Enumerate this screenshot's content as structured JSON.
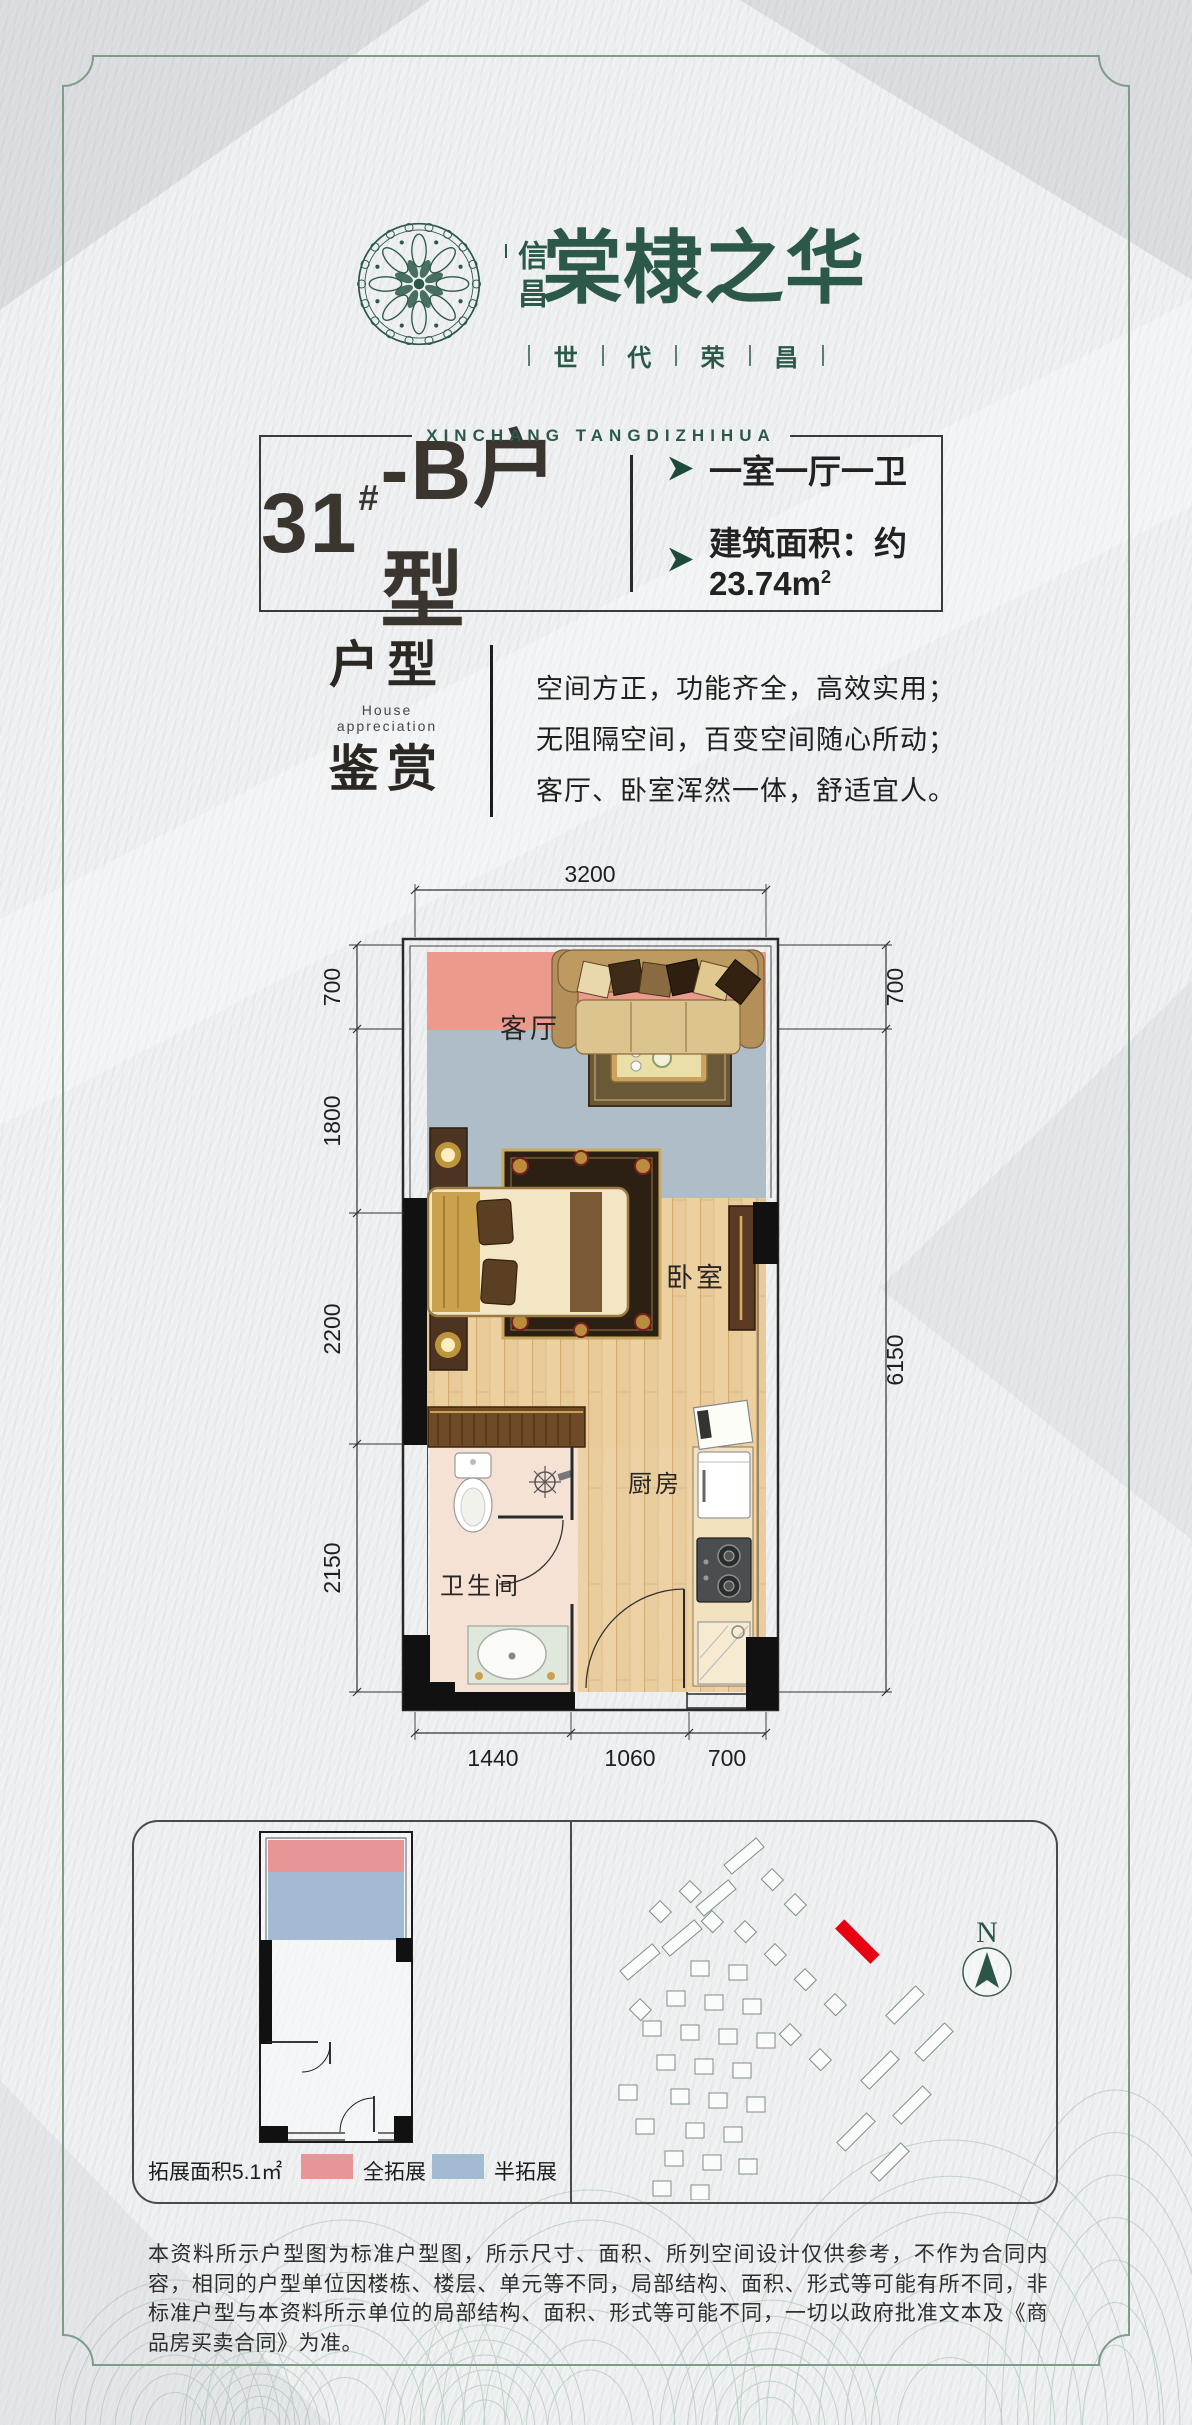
{
  "brand": {
    "logo_sub": "信昌",
    "name": "棠棣之华",
    "slogan_chars": [
      "世",
      "代",
      "荣",
      "昌"
    ],
    "romanized": "XINCHANG TANGDIZHIHUA"
  },
  "title": {
    "unit_number": "31",
    "unit_hash": "#",
    "unit_suffix": "-B户型",
    "feature_rooms": "一室一厅一卫",
    "feature_area": "建筑面积：约23.74m",
    "feature_area_sup": "2"
  },
  "appreciation": {
    "word1": "户型",
    "en": "House appreciation",
    "word2": "鉴赏",
    "line1": "空间方正，功能齐全，高效实用；",
    "line2": "无阻隔空间，百变空间随心所动；",
    "line3": "客厅、卧室浑然一体，舒适宜人。"
  },
  "floor_plan": {
    "dim_top": "3200",
    "dims_left": [
      "700",
      "1800",
      "2200",
      "2150"
    ],
    "dims_right": [
      "700",
      "6150"
    ],
    "dims_bottom": [
      "1440",
      "1060",
      "700"
    ],
    "rooms": {
      "living": "客厅",
      "bedroom": "卧室",
      "bath": "卫生间",
      "kitchen": "厨房"
    }
  },
  "extension": {
    "area_label": "拓展面积5.1㎡",
    "legend_full": "全拓展",
    "legend_half": "半拓展"
  },
  "site": {
    "north_label": "N"
  },
  "disclaimer": "本资料所示户型图为标准户型图，所示尺寸、面积、所列空间设计仅供参考，不作为合同内容，相同的户型单位因楼栋、楼层、单元等不同，局部结构、面积、形式等可能有所不同，非标准户型与本资料所示单位的局部结构、面积、形式等可能不同，一切以政府批准文本及《商品房买卖合同》为准。",
  "colors": {
    "brand_green": "#2b5848",
    "frame_green": "#7d9c8a",
    "zone_full_pink": "#ec9a8e",
    "zone_half_blue": "#aebdc8",
    "legend_pink": "#e79596",
    "legend_blue": "#a3bad3",
    "highlight_red": "#e60012"
  }
}
